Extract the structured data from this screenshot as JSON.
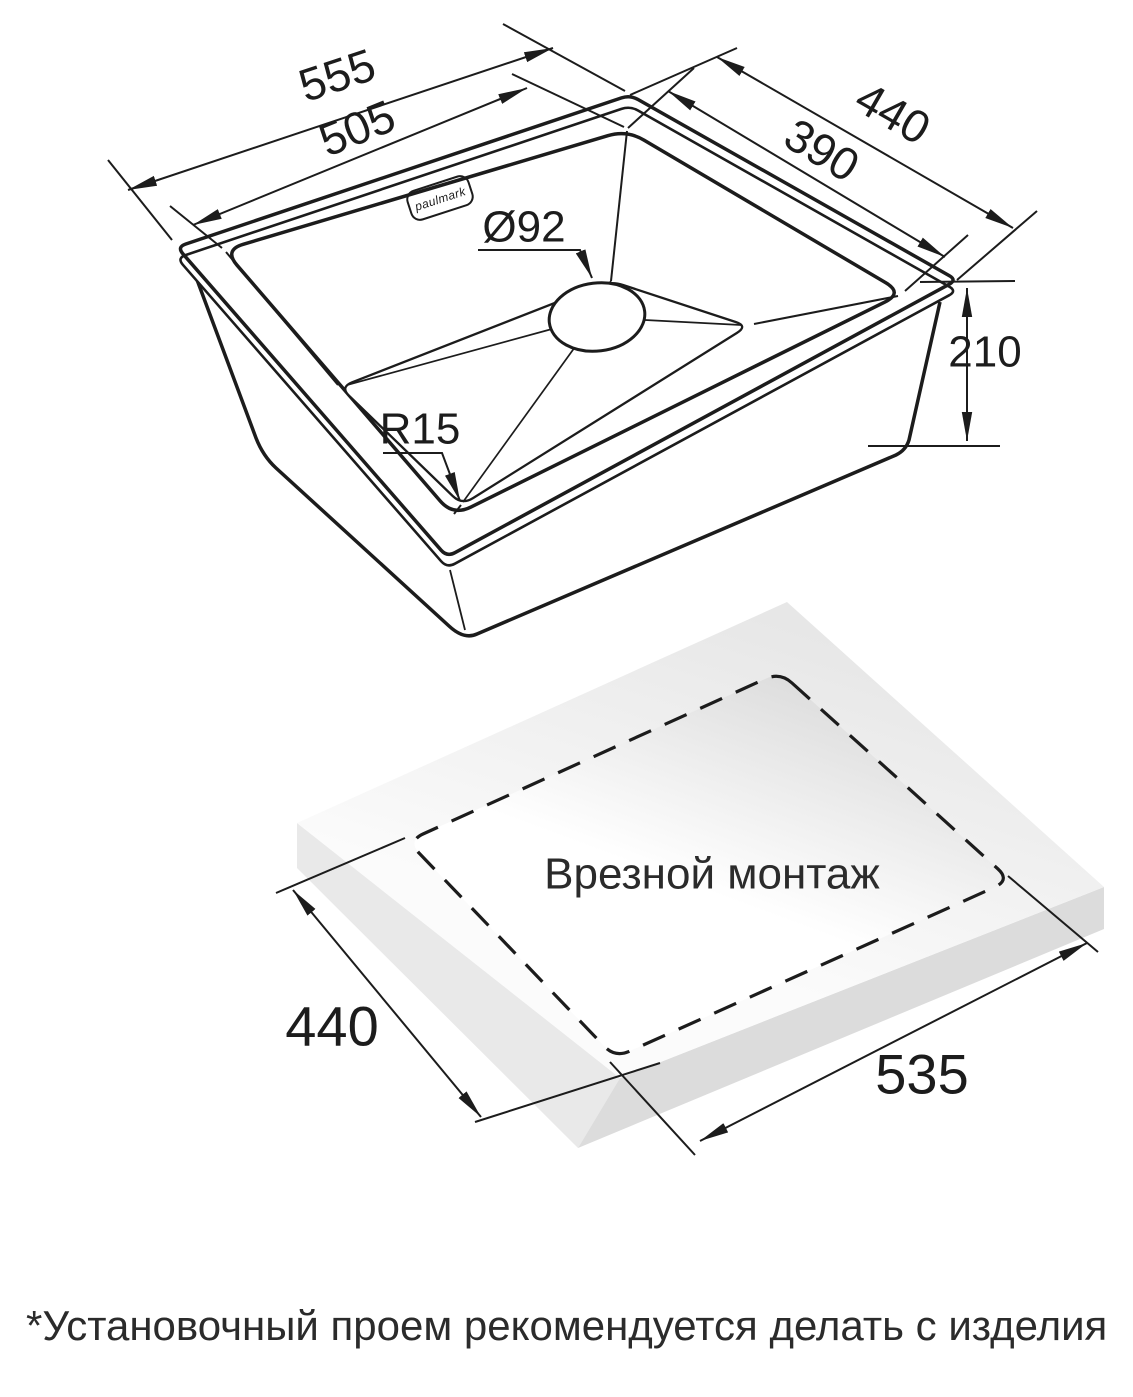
{
  "sink": {
    "brand": "paulmark",
    "outer_length": "555",
    "bowl_length": "505",
    "outer_width": "440",
    "bowl_width": "390",
    "drain_diameter": "Ø92",
    "bottom_radius": "R15",
    "depth": "210"
  },
  "cutout": {
    "title": "Врезной монтаж",
    "width": "440",
    "length": "535"
  },
  "footnote": "*Установочный проем рекомендуется делать с изделия",
  "colors": {
    "line": "#1c1c1c",
    "countertop_light": "#ededed",
    "countertop_side_left": "#e9e9e9",
    "countertop_side_right": "#dcdcdc",
    "background": "#ffffff"
  }
}
